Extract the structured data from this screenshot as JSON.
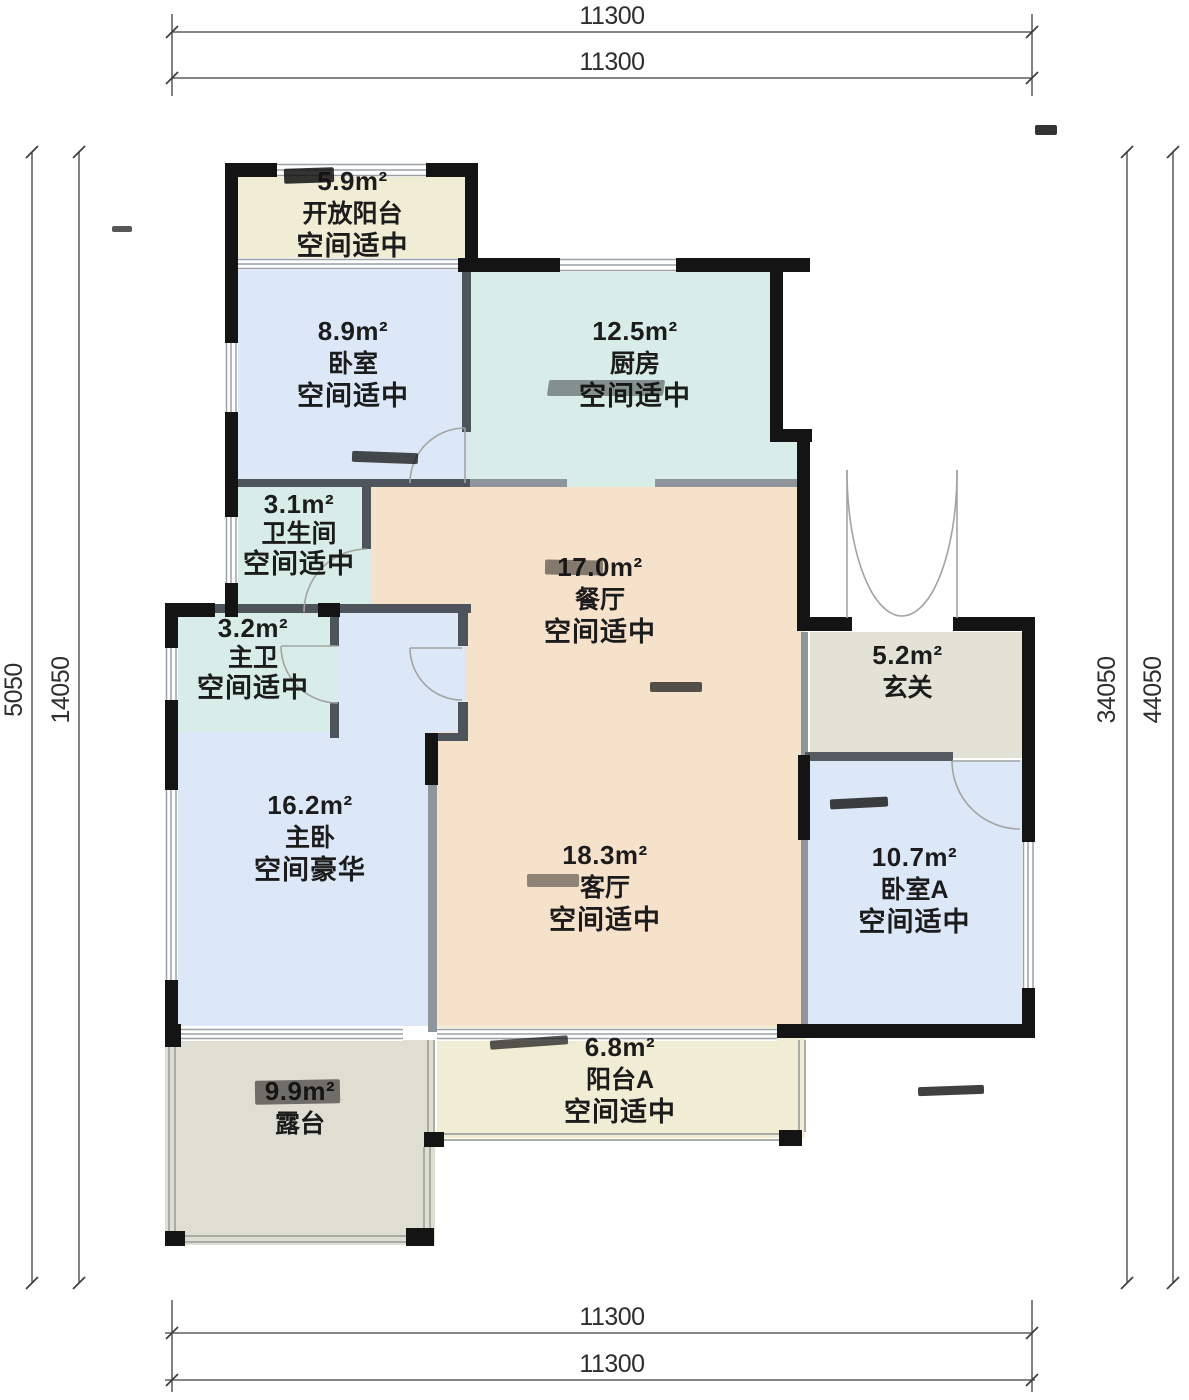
{
  "palette": {
    "fill_balcony": "#f1edd5",
    "fill_bedroom": "#dce7f7",
    "fill_kitchen": "#d8ede7",
    "fill_dining": "#f6e2cb",
    "fill_hall": "#e3e2d7",
    "fill_terrace": "#dfded2",
    "wall": "#141414",
    "partition": "#4d545b",
    "partition_light": "#8e959c",
    "window_line": "#9aa1a8",
    "railing": "#a9ada6",
    "door_arc": "#a3a3a3",
    "dim_line": "#3f3f3f",
    "text": "#1c1c1c"
  },
  "dimensions": {
    "top": [
      "11300",
      "11300"
    ],
    "bottom": [
      "11300",
      "11300"
    ],
    "left": [
      "5050",
      "14050"
    ],
    "right": [
      "34050",
      "44050"
    ]
  },
  "rooms": {
    "open_balcony": {
      "area": "5.9m²",
      "name": "开放阳台",
      "note": "空间适中"
    },
    "bedroom": {
      "area": "8.9m²",
      "name": "卧室",
      "note": "空间适中"
    },
    "kitchen": {
      "area": "12.5m²",
      "name": "厨房",
      "note": "空间适中"
    },
    "bathroom": {
      "area": "3.1m²",
      "name": "卫生间",
      "note": "空间适中"
    },
    "master_bath": {
      "area": "3.2m²",
      "name": "主卫",
      "note": "空间适中"
    },
    "dining": {
      "area": "17.0m²",
      "name": "餐厅",
      "note": "空间适中"
    },
    "hall": {
      "area": "5.2m²",
      "name": "玄关",
      "note": ""
    },
    "master_bedroom": {
      "area": "16.2m²",
      "name": "主卧",
      "note": "空间豪华"
    },
    "living": {
      "area": "18.3m²",
      "name": "客厅",
      "note": "空间适中"
    },
    "bedroom_a": {
      "area": "10.7m²",
      "name": "卧室A",
      "note": "空间适中"
    },
    "balcony_a": {
      "area": "6.8m²",
      "name": "阳台A",
      "note": "空间适中"
    },
    "terrace": {
      "area": "9.9m²",
      "name": "露台",
      "note": ""
    }
  }
}
